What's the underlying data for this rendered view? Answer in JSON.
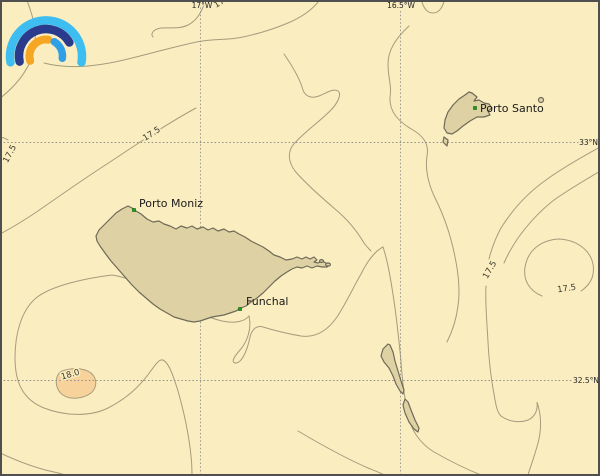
{
  "map": {
    "region_description": "Madeira archipelago sea chart with temperature contours",
    "colors": {
      "ocean": "#FAEDC0",
      "land": "#DED2A4",
      "land_outline": "#6E6A58",
      "contour": "#A59C7D",
      "warm_region": "#F8D29B",
      "grid": "#8F8F8F",
      "frame": "#4F4F4F",
      "place_marker": "#17A317"
    },
    "grid": {
      "longitude_labels": [
        {
          "text": "17°W"
        },
        {
          "text": "16.5°W"
        }
      ],
      "latitude_labels": [
        {
          "text": "33°N"
        },
        {
          "text": "32.5°N"
        }
      ]
    },
    "places": [
      {
        "name": "Porto Moniz"
      },
      {
        "name": "Funchal"
      },
      {
        "name": "Porto Santo"
      }
    ],
    "contour_labels": [
      {
        "text": "17.5",
        "location": "top-edge-cut"
      },
      {
        "text": "17.5",
        "location": "left-edge"
      },
      {
        "text": "17.5",
        "location": "northwest-diagonal"
      },
      {
        "text": "17.5",
        "location": "east-steep"
      },
      {
        "text": "17.5",
        "location": "east-loop"
      },
      {
        "text": "18.0",
        "location": "southwest-warm-patch"
      }
    ],
    "logo": {
      "name": "rainbow-arcs",
      "outer_color": "#3EBEF0",
      "middle_color": "#2A3A8C",
      "inner_left_color": "#F5A623",
      "inner_right_color": "#2F9FE8"
    }
  }
}
